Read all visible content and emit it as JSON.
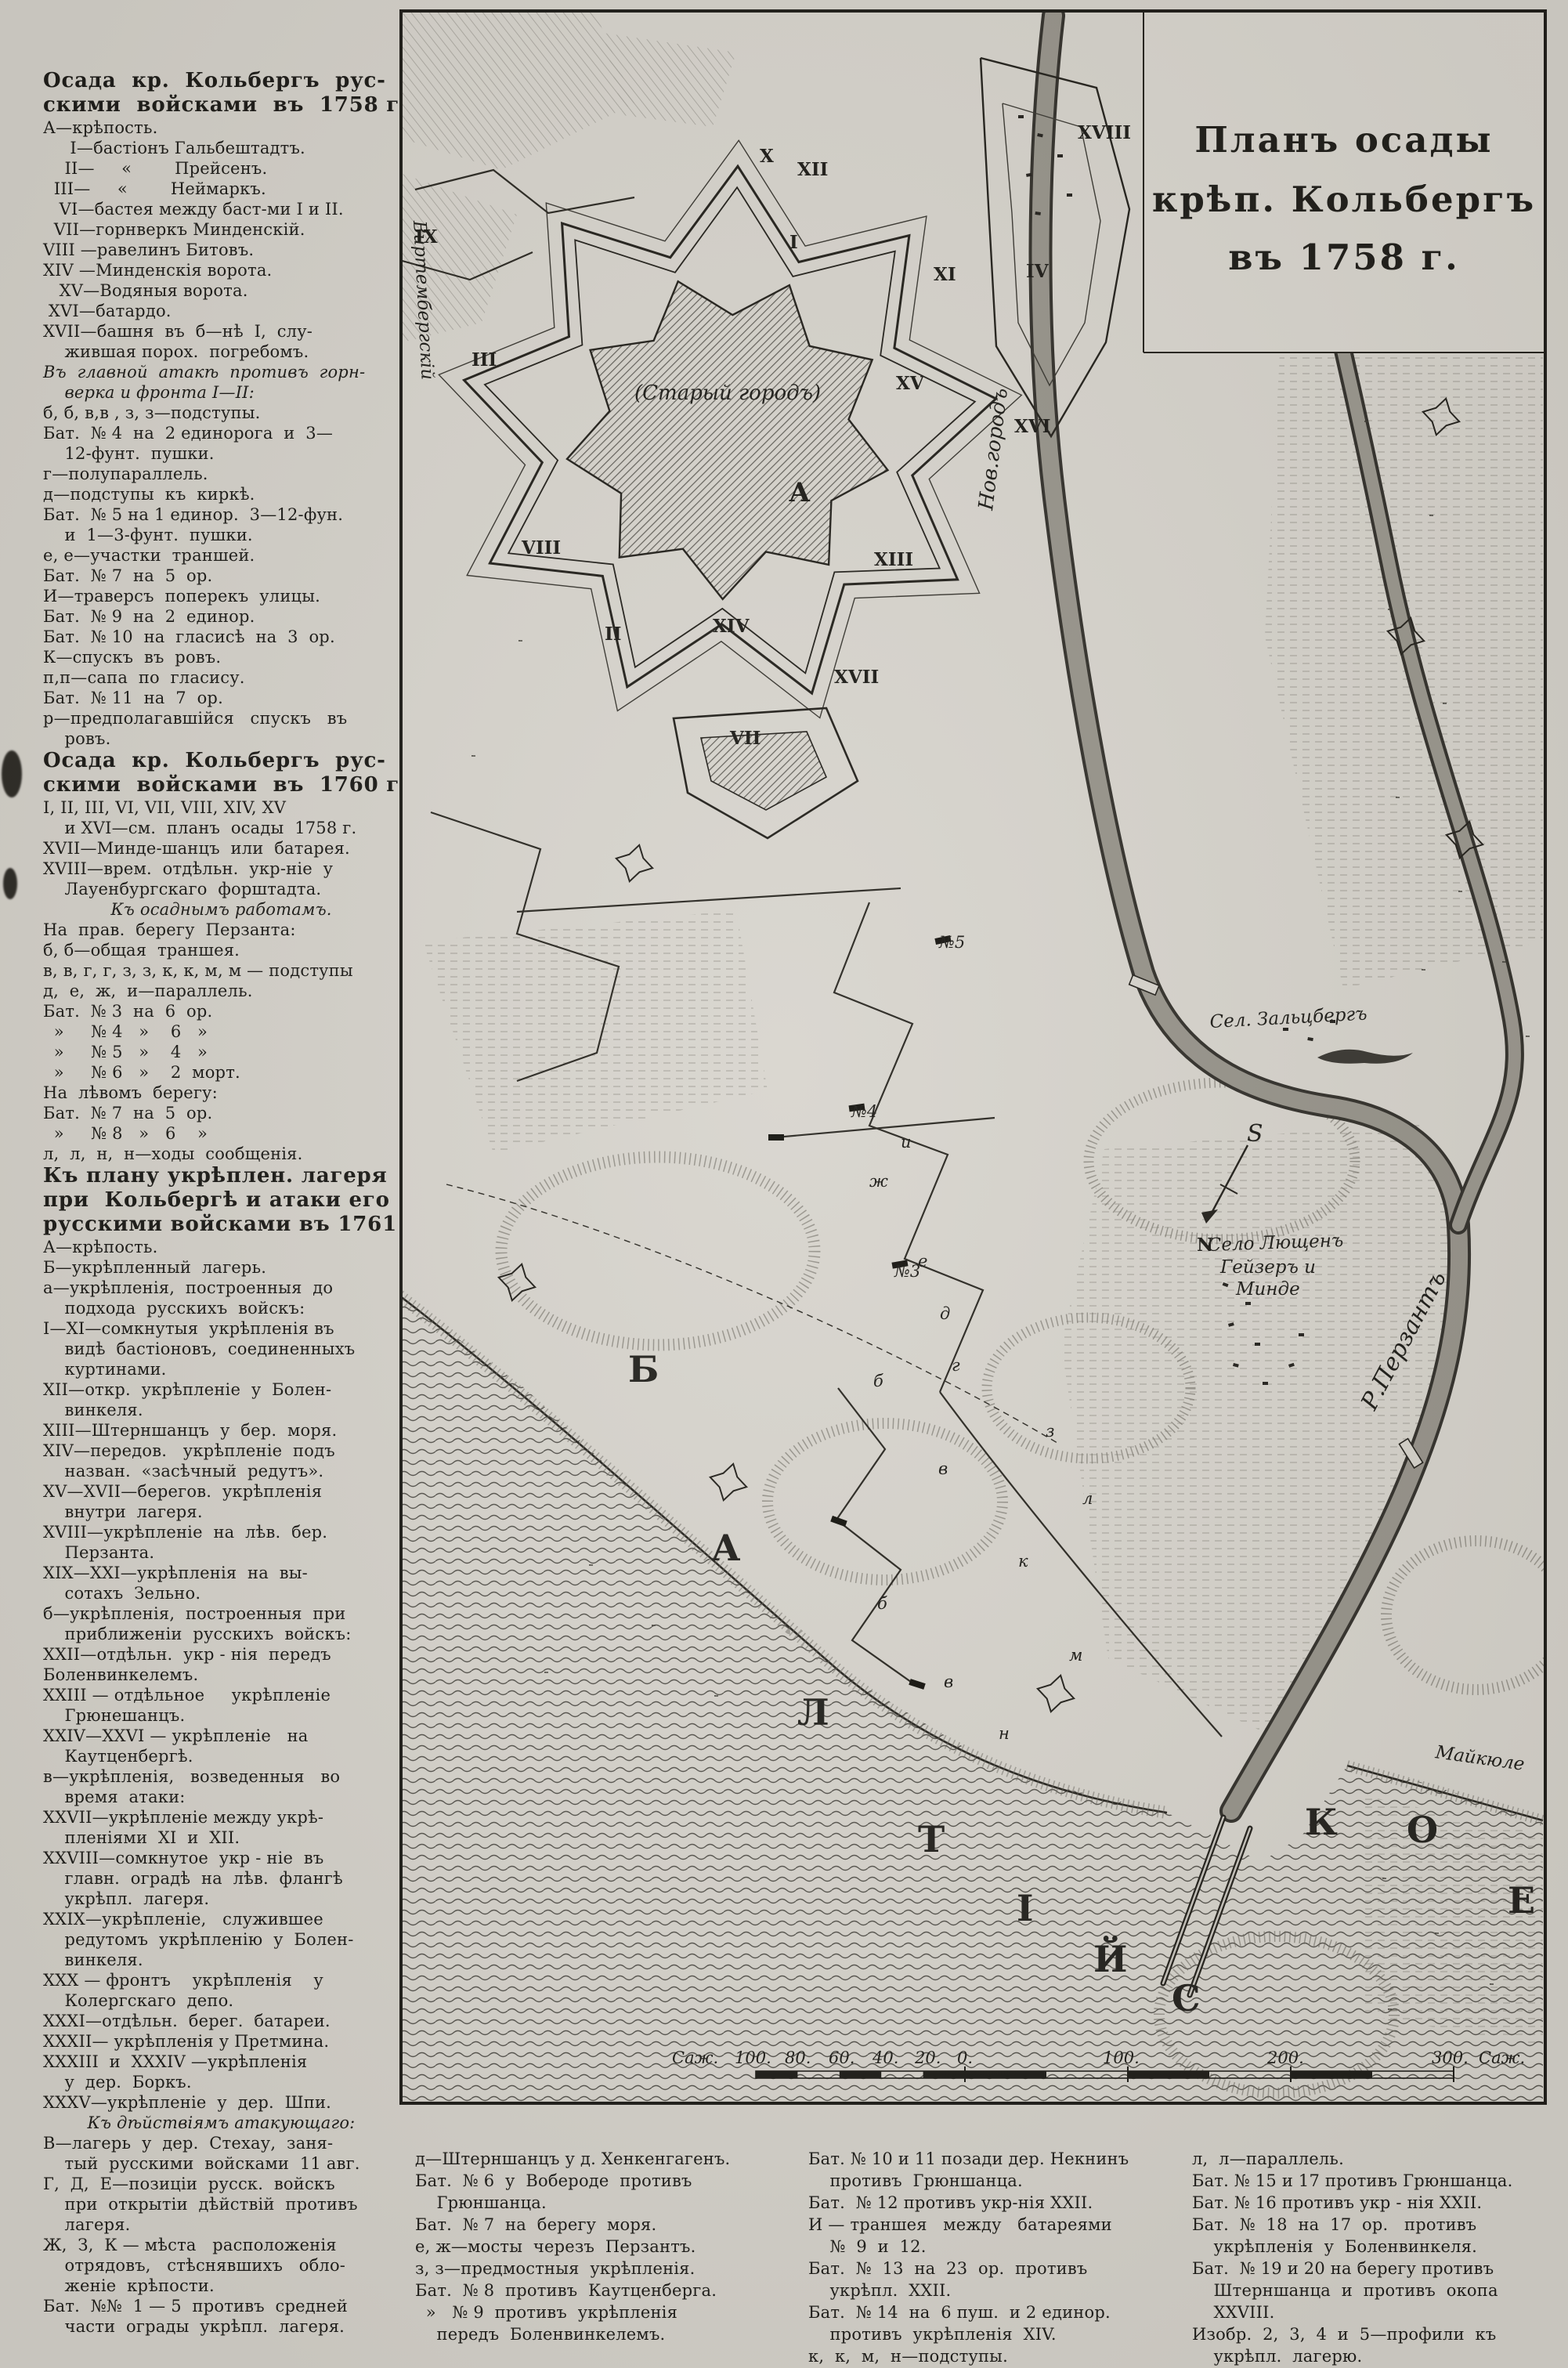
{
  "legend_1758_header": "Осада кр. Кольбергъ русскими войсками въ 1758 г.",
  "col1": [
    {
      "t": "Осада  кр.  Кольбергъ  рус-",
      "s": "h"
    },
    {
      "t": "скими  войсками  въ  1758 г.",
      "s": "h"
    },
    {
      "t": "А—крѣпость.",
      "s": "b"
    },
    {
      "t": "     I—бастіонъ Гальбештадтъ.",
      "s": "b"
    },
    {
      "t": "    II—     «        Прейсенъ.",
      "s": "b"
    },
    {
      "t": "  III—     «        Неймаркъ.",
      "s": "b"
    },
    {
      "t": "   VI—бастея между баст-ми I и II.",
      "s": "b"
    },
    {
      "t": "  VII—горнверкъ Минденскій.",
      "s": "b"
    },
    {
      "t": "VIII —равелинъ Битовъ.",
      "s": "b"
    },
    {
      "t": "XIV —Минденскія ворота.",
      "s": "b"
    },
    {
      "t": "   XV—Водяныя ворота.",
      "s": "b"
    },
    {
      "t": " XVI—батардо.",
      "s": "b"
    },
    {
      "t": "XVII—башня  въ  б—нѣ  I,  слу-",
      "s": "b"
    },
    {
      "t": "    жившая порох.  погребомъ.",
      "s": "b"
    },
    {
      "t": "Въ  главной  атакѣ  противъ  горн-",
      "s": "i"
    },
    {
      "t": "    верка и фронта I—II:",
      "s": "i"
    },
    {
      "t": "б, б, в,в , з, з—подступы.",
      "s": "b"
    },
    {
      "t": "Бат.  № 4  на  2 единорога  и  3—",
      "s": "b"
    },
    {
      "t": "    12-фунт.  пушки.",
      "s": "b"
    },
    {
      "t": "г—полупараллель.",
      "s": "b"
    },
    {
      "t": "д—подступы  къ  киркѣ.",
      "s": "b"
    },
    {
      "t": "Бат.  № 5 на 1 единор.  3—12-фун.",
      "s": "b"
    },
    {
      "t": "    и  1—3-фунт.  пушки.",
      "s": "b"
    },
    {
      "t": "е, е—участки  траншей.",
      "s": "b"
    },
    {
      "t": "Бат.  № 7  на  5  ор.",
      "s": "b"
    },
    {
      "t": "И—траверсъ  поперекъ  улицы.",
      "s": "b"
    },
    {
      "t": "Бат.  № 9  на  2  единор.",
      "s": "b"
    },
    {
      "t": "Бат.  № 10  на  гласисѣ  на  3  ор.",
      "s": "b"
    },
    {
      "t": "К—спускъ  въ  ровъ.",
      "s": "b"
    },
    {
      "t": "п,п—сапа  по  гласису.",
      "s": "b"
    },
    {
      "t": "Бат.  № 11  на  7  ор.",
      "s": "b"
    },
    {
      "t": "р—предполагавшійся   спускъ   въ",
      "s": "b"
    },
    {
      "t": "    ровъ.",
      "s": "b"
    },
    {
      "t": "Осада  кр.  Кольбергъ  рус-",
      "s": "h"
    },
    {
      "t": "скими  войсками  въ  1760 г.",
      "s": "h"
    },
    {
      "t": "I, II, III, VI, VII, VIII, XIV, XV",
      "s": "b"
    },
    {
      "t": "    и XVI—см.  планъ  осады  1758 г.",
      "s": "b"
    },
    {
      "t": "XVII—Минде-шанцъ  или  батарея.",
      "s": "b"
    },
    {
      "t": "XVIII—врем.  отдѣльн.  укр-ніе  у",
      "s": "b"
    },
    {
      "t": "    Лауенбургскаго  форштадта.",
      "s": "b"
    },
    {
      "t": "Къ осаднымъ работамъ.",
      "s": "ic"
    },
    {
      "t": "На  прав.  берегу  Перзанта:",
      "s": "b"
    },
    {
      "t": "б, б—общая  траншея.",
      "s": "b"
    },
    {
      "t": "в, в, г, г, з, з, к, к, м, м — подступы",
      "s": "b"
    },
    {
      "t": "д,  е,  ж,  и—параллель.",
      "s": "b"
    },
    {
      "t": "Бат.  № 3  на  6  ор.",
      "s": "b"
    },
    {
      "t": "  »     № 4   »    6   »",
      "s": "b"
    },
    {
      "t": "  »     № 5   »    4   »",
      "s": "b"
    },
    {
      "t": "  »     № 6   »    2  морт.",
      "s": "b"
    },
    {
      "t": "На  лѣвомъ  берегу:",
      "s": "b"
    },
    {
      "t": "Бат.  № 7  на  5  ор.",
      "s": "b"
    },
    {
      "t": "  »     № 8   »   6    »",
      "s": "b"
    },
    {
      "t": "л,  л,  н,  н—ходы  сообщенія.",
      "s": "b"
    },
    {
      "t": "Къ плану укрѣплен. лагеря",
      "s": "h"
    },
    {
      "t": "при  Кольбергѣ и атаки его",
      "s": "h"
    },
    {
      "t": "русскими войсками въ 1761 г.",
      "s": "h"
    },
    {
      "t": "А—крѣпость.",
      "s": "b"
    },
    {
      "t": "Б—укрѣпленный  лагерь.",
      "s": "b"
    },
    {
      "t": "а—укрѣпленія,  построенныя  до",
      "s": "b"
    },
    {
      "t": "    подхода  русскихъ  войскъ:",
      "s": "b"
    },
    {
      "t": "I—XI—сомкнутыя  укрѣпленія въ",
      "s": "b"
    },
    {
      "t": "    видѣ  бастіоновъ,  соединенныхъ",
      "s": "b"
    },
    {
      "t": "    куртинами.",
      "s": "b"
    },
    {
      "t": "XII—откр.  укрѣпленіе  у  Болен-",
      "s": "b"
    },
    {
      "t": "    винкеля.",
      "s": "b"
    },
    {
      "t": "XIII—Штерншанцъ  у  бер.  моря.",
      "s": "b"
    },
    {
      "t": "XIV—передов.   укрѣпленіе  подъ",
      "s": "b"
    },
    {
      "t": "    назван.  «засѣчный  редутъ».",
      "s": "b"
    },
    {
      "t": "XV—XVII—берегов.  укрѣпленія",
      "s": "b"
    },
    {
      "t": "    внутри  лагеря.",
      "s": "b"
    },
    {
      "t": "XVIII—укрѣпленіе  на  лѣв.  бер.",
      "s": "b"
    },
    {
      "t": "    Перзанта.",
      "s": "b"
    },
    {
      "t": "XIX—XXI—укрѣпленія  на  вы-",
      "s": "b"
    },
    {
      "t": "    сотахъ  Зельно.",
      "s": "b"
    },
    {
      "t": "б—укрѣпленія,  построенныя  при",
      "s": "b"
    },
    {
      "t": "    приближеніи  русскихъ  войскъ:",
      "s": "b"
    },
    {
      "t": "XXII—отдѣльн.  укр - нія  передъ",
      "s": "b"
    },
    {
      "t": "Боленвинкелемъ.",
      "s": "b"
    },
    {
      "t": "XXIII — отдѣльное     укрѣпленіе",
      "s": "b"
    },
    {
      "t": "    Грюнешанцъ.",
      "s": "b"
    },
    {
      "t": "XXIV—XXVI — укрѣпленіе   на",
      "s": "b"
    },
    {
      "t": "    Каутценбергѣ.",
      "s": "b"
    },
    {
      "t": "в—укрѣпленія,   возведенныя   во",
      "s": "b"
    },
    {
      "t": "    время  атаки:",
      "s": "b"
    },
    {
      "t": "XXVII—укрѣпленіе между укрѣ-",
      "s": "b"
    },
    {
      "t": "    пленіями  XI  и  XII.",
      "s": "b"
    },
    {
      "t": "XXVIII—сомкнутое  укр - ніе  въ",
      "s": "b"
    },
    {
      "t": "    главн.  оградѣ  на  лѣв.  флангѣ",
      "s": "b"
    },
    {
      "t": "    укрѣпл.  лагеря.",
      "s": "b"
    },
    {
      "t": "XXIX—укрѣпленіе,   служившее",
      "s": "b"
    },
    {
      "t": "    редутомъ  укрѣпленію  у  Болен-",
      "s": "b"
    },
    {
      "t": "    винкеля.",
      "s": "b"
    },
    {
      "t": "XXX — фронтъ    укрѣпленія    у",
      "s": "b"
    },
    {
      "t": "    Колергскаго  депо.",
      "s": "b"
    },
    {
      "t": "XXXI—отдѣльн.  берег.  батареи.",
      "s": "b"
    },
    {
      "t": "XXXII— укрѣпленія у Претмина.",
      "s": "b"
    },
    {
      "t": "XXXIII  и  XXXIV —укрѣпленія",
      "s": "b"
    },
    {
      "t": "    у  дер.  Боркъ.",
      "s": "b"
    },
    {
      "t": "XXXV—укрѣпленіе  у  дер.  Шпи.",
      "s": "b"
    },
    {
      "t": "Къ дѣйствіямъ атакующаго:",
      "s": "ic"
    },
    {
      "t": "В—лагерь  у  дер.  Стехау,  заня-",
      "s": "b"
    },
    {
      "t": "    тый  русскими  войсками  11 авг.",
      "s": "b"
    },
    {
      "t": "Г,  Д,  Е—позиціи  русск.  войскъ",
      "s": "b"
    },
    {
      "t": "    при  открытіи  дѣйствій  противъ",
      "s": "b"
    },
    {
      "t": "    лагеря.",
      "s": "b"
    },
    {
      "t": "Ж,  З,  К — мѣста   расположенія",
      "s": "b"
    },
    {
      "t": "    отрядовъ,   стѣснявшихъ   обло-",
      "s": "b"
    },
    {
      "t": "    женіе  крѣпости.",
      "s": "b"
    },
    {
      "t": "Бат.  №№  1 — 5  противъ  средней",
      "s": "b"
    },
    {
      "t": "    части  ограды  укрѣпл.  лагеря.",
      "s": "b"
    }
  ],
  "col2": [
    {
      "t": "д—Штерншанцъ у д. Хенкенгагенъ.",
      "s": "b"
    },
    {
      "t": "Бат.  № 6  у  Вобероде  противъ",
      "s": "b"
    },
    {
      "t": "    Грюншанца.",
      "s": "b"
    },
    {
      "t": "Бат.  № 7  на  берегу  моря.",
      "s": "b"
    },
    {
      "t": "е, ж—мосты  черезъ  Перзантъ.",
      "s": "b"
    },
    {
      "t": "з, з—предмостныя  укрѣпленія.",
      "s": "b"
    },
    {
      "t": "Бат.  № 8  противъ  Каутценберга.",
      "s": "b"
    },
    {
      "t": "  »   № 9  противъ  укрѣпленія",
      "s": "b"
    },
    {
      "t": "    передъ  Боленвинкелемъ.",
      "s": "b"
    }
  ],
  "col3": [
    {
      "t": "Бат. № 10 и 11 позади дер. Некнинъ",
      "s": "b"
    },
    {
      "t": "    противъ  Грюншанца.",
      "s": "b"
    },
    {
      "t": "Бат.  № 12 противъ укр-нія XXII.",
      "s": "b"
    },
    {
      "t": "И — траншея   между   батареями",
      "s": "b"
    },
    {
      "t": "    №  9  и  12.",
      "s": "b"
    },
    {
      "t": "Бат.  №  13  на  23  ор.  противъ",
      "s": "b"
    },
    {
      "t": "    укрѣпл.  XXII.",
      "s": "b"
    },
    {
      "t": "Бат.  № 14  на  6 пуш.  и 2 единор.",
      "s": "b"
    },
    {
      "t": "    противъ  укрѣпленія  XIV.",
      "s": "b"
    },
    {
      "t": "к,  к,  м,  н—подступы.",
      "s": "b"
    }
  ],
  "col4": [
    {
      "t": "л,  л—параллель.",
      "s": "b"
    },
    {
      "t": "Бат. № 15 и 17 противъ Грюншанца.",
      "s": "b"
    },
    {
      "t": "Бат. № 16 противъ укр - нія XXII.",
      "s": "b"
    },
    {
      "t": "Бат.  №  18  на  17  ор.   противъ",
      "s": "b"
    },
    {
      "t": "    укрѣпленія  у  Боленвинкеля.",
      "s": "b"
    },
    {
      "t": "Бат.  № 19 и 20 на берегу противъ",
      "s": "b"
    },
    {
      "t": "    Штерншанца  и  противъ  окопа",
      "s": "b"
    },
    {
      "t": "    XXVIII.",
      "s": "b"
    },
    {
      "t": "Изобр.  2,  3,  4  и  5—профили  къ",
      "s": "b"
    },
    {
      "t": "    укрѣпл.  лагерю.",
      "s": "b"
    }
  ],
  "map": {
    "title": [
      "Планъ осады",
      "крѣп. Кольбергъ",
      "въ 1758 г."
    ],
    "labels": {
      "old_town": "(Старый городъ)",
      "fortress_a": "А",
      "new_town": "Нов.городъ",
      "river": "Р.Перзантъ",
      "salzberg": "Сел. Зальцбергъ",
      "village_line1": "Село Лющенъ",
      "village_line2": "Гейзеръ и",
      "village_line3": "Минде",
      "maikuhle": "Майкюле",
      "camp_road": "Виртембергскій",
      "north": "N",
      "south": "S"
    },
    "sea_letters": [
      "Б",
      "А",
      "Л",
      "Т",
      "І",
      "Й",
      "С",
      "К",
      "О",
      "Е"
    ],
    "numerals": {
      "i": "I",
      "ii": "II",
      "iii": "III",
      "iv": "IV",
      "vii": "VII",
      "viii": "VIII",
      "ix": "IX",
      "x": "X",
      "xi": "XI",
      "xii": "XII",
      "xiii": "XIII",
      "xiv": "XIV",
      "xv": "XV",
      "xvi": "XVI",
      "xvii": "XVII",
      "xviii": "XVIII"
    },
    "marks": {
      "b1": "б",
      "b2": "б",
      "v1": "в",
      "v2": "в",
      "g": "г",
      "d": "д",
      "e": "е",
      "zh": "ж",
      "z": "з",
      "i": "и",
      "k": "к",
      "l": "л",
      "m": "м",
      "n": "н",
      "no3": "№3",
      "no4": "№4",
      "no5": "№5"
    },
    "scale": {
      "left_unit": "Саж.",
      "n100": "100.",
      "n80": "80.",
      "n60": "60.",
      "n40": "40.",
      "n20": "20.",
      "n0": "0.",
      "r100": "100.",
      "r200": "200.",
      "r300": "300.",
      "right_unit": "Саж."
    },
    "ink": "#1d1c18",
    "paper": "#d6d3cc"
  }
}
